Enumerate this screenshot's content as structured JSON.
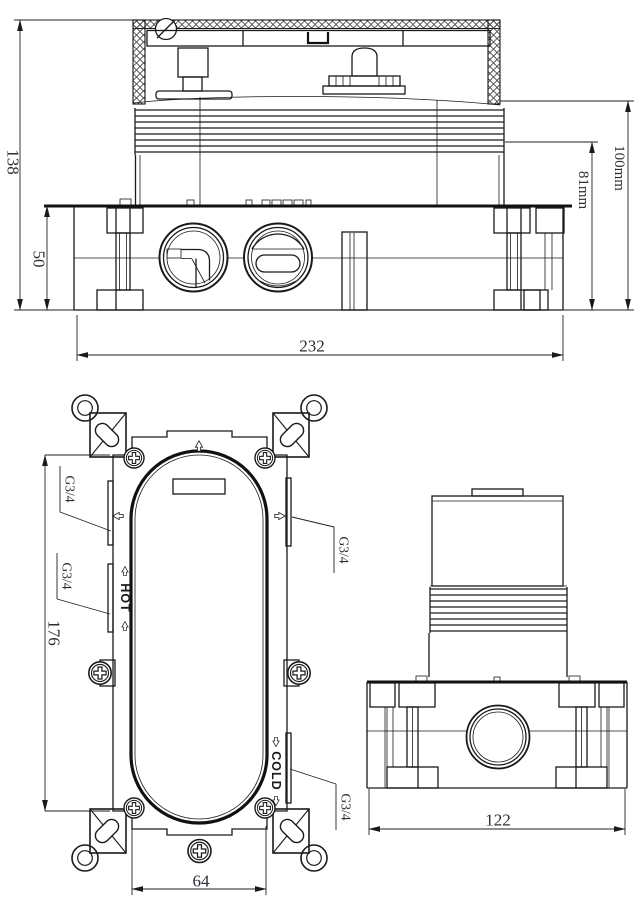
{
  "front_view": {
    "title": "front elevation of concealed valve body",
    "dims": {
      "overall_height": "138",
      "box_height": "50",
      "overall_width": "232",
      "depth_to_thread": "81mm",
      "depth_overall": "100mm"
    }
  },
  "plan_view": {
    "title": "face view of mounting bracket",
    "dims": {
      "body_length": "176",
      "outlet_spacing": "64"
    },
    "ports": {
      "left_top": "G3/4",
      "left_bottom": "G3/4",
      "right_top": "G3/4",
      "right_bottom": "G3/4"
    },
    "labels": {
      "hot": "HOT",
      "cold": "COLD"
    }
  },
  "side_view": {
    "title": "side elevation",
    "dims": {
      "overall_width": "122"
    }
  }
}
